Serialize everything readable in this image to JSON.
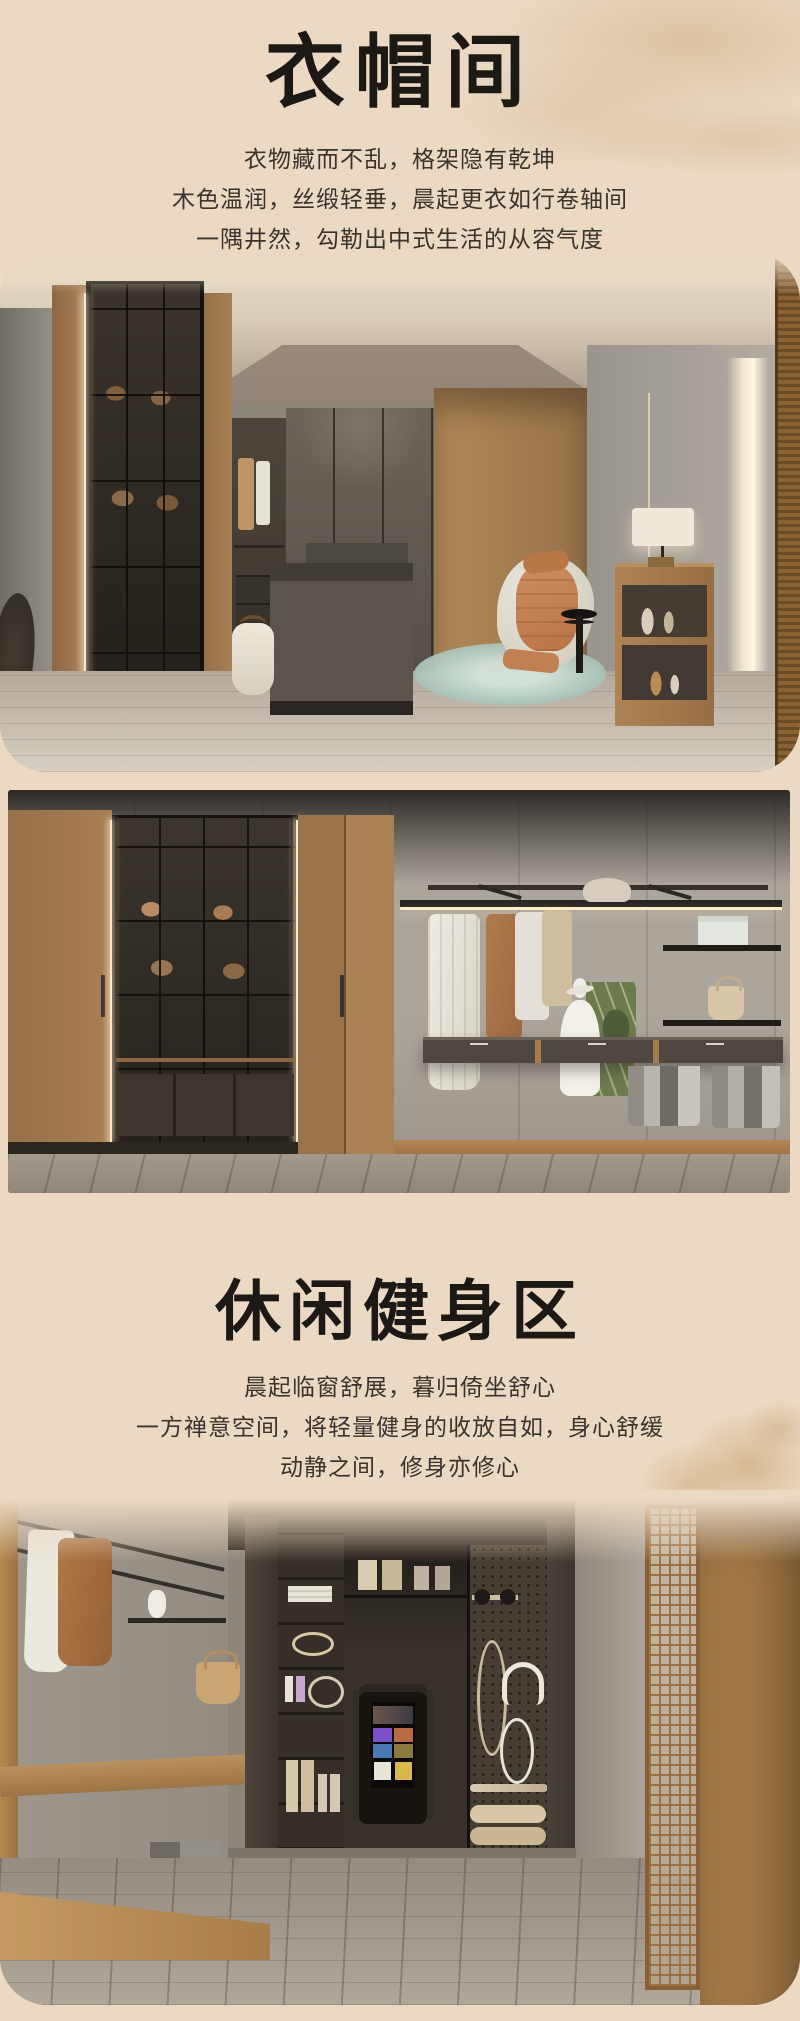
{
  "page": {
    "background_color": "#ebd9c3",
    "title_color": "#1c1915",
    "text_color": "#39342d",
    "accent_wood_color": "#a87e52",
    "accent_rug_color": "#a7c2b7"
  },
  "section_cloakroom": {
    "title": "衣帽间",
    "lines": [
      "衣物藏而不乱，格架隐有乾坤",
      "木色温润，丝缎轻垂，晨起更衣如行卷轴间",
      "一隅井然，勾勒出中式生活的从容气度"
    ]
  },
  "section_fitness": {
    "title": "休闲健身区",
    "lines": [
      "晨起临窗舒展，暮归倚坐舒心",
      "一方禅意空间，将轻量健身的收放自如，身心舒缓",
      "动静之间，修身亦修心"
    ]
  }
}
